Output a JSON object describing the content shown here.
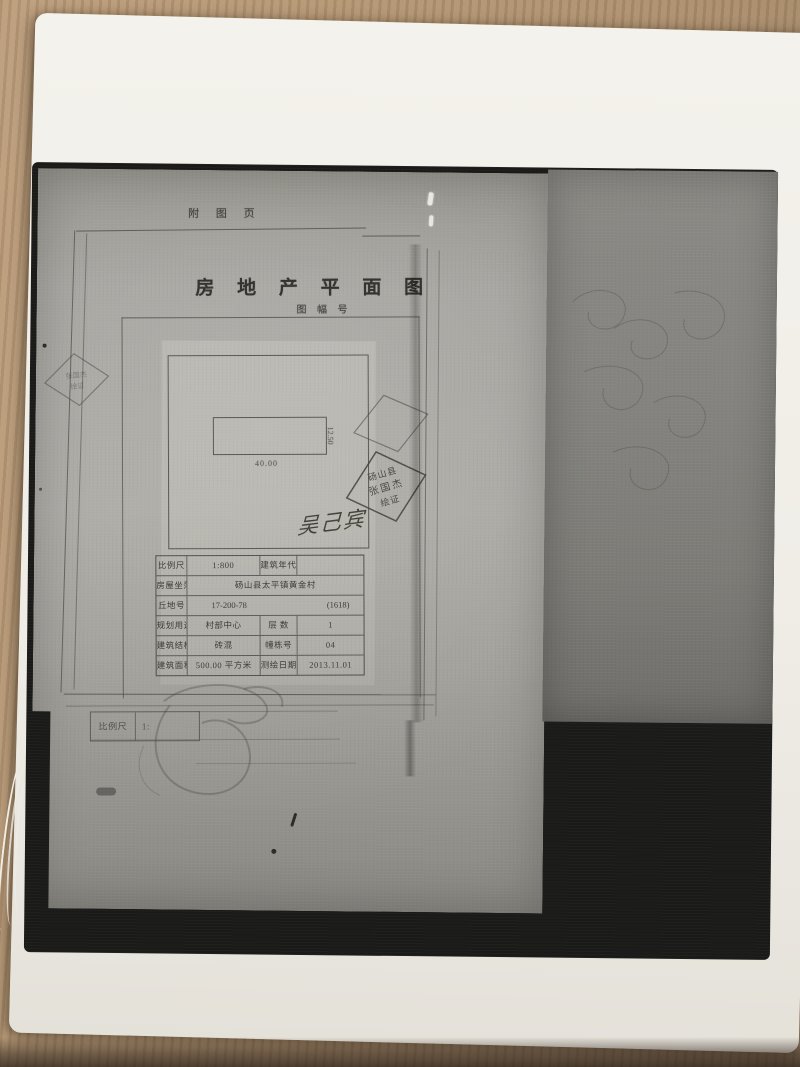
{
  "photo": {
    "colors": {
      "wood_desk": "#b49673",
      "paper_white": "#f2efe9",
      "photocopy_black": "#1a1a19",
      "photocopy_gray": "#a7a5a0",
      "document_ink": "#3f3e3a"
    }
  },
  "document": {
    "attachment_label": "附 图 页",
    "title": "房 地 产 平 面 图",
    "sheet_number_label": "图 幅 号",
    "plan": {
      "width_label": "40.00",
      "depth_label": "12.50"
    },
    "surveyor_stamp": {
      "line1": "砀山县",
      "line2": "张国杰",
      "line3": "绘证"
    },
    "signature": "吴己宾",
    "info_table": {
      "rows": [
        {
          "c1": "比例尺",
          "c2": "1:800",
          "c3": "建筑年代",
          "c4": ""
        },
        {
          "c1": "房屋坐落",
          "c2": "砀山县太平镇黄金村"
        },
        {
          "c1": "丘地号",
          "c2": "17-200-78",
          "c4": "(1618)"
        },
        {
          "c1": "规划用途",
          "c2": "村部中心",
          "c3": "层 数",
          "c4": "1"
        },
        {
          "c1": "建筑结构",
          "c2": "砖混",
          "c3": "幢栋号",
          "c4": "04"
        },
        {
          "c1": "建筑面积",
          "c2": "500.00 平方米",
          "c3": "测绘日期",
          "c4": "2013.11.01"
        }
      ]
    },
    "footer_scale_box": {
      "label": "比例尺",
      "value": "1:"
    }
  }
}
